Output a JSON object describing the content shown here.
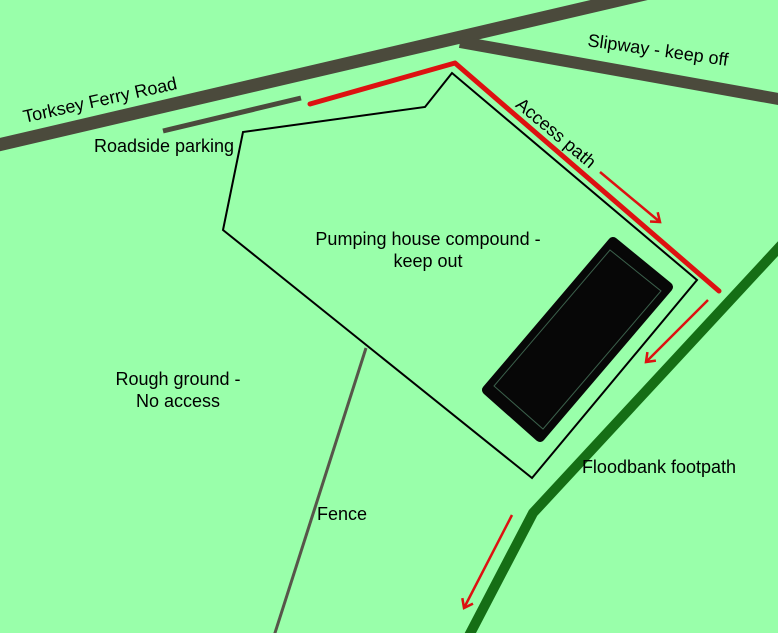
{
  "map": {
    "colors": {
      "background": "#99ffaa",
      "road": "#4b4a3c",
      "boundary": "#000000",
      "fence": "#57564a",
      "access_path": "#dd1111",
      "floodbank": "#156e15",
      "building": "#070707",
      "building_outline": "#4e7f63",
      "label_text": "#000000"
    },
    "labels": {
      "torksey_ferry_road": "Torksey Ferry Road",
      "slipway": "Slipway - keep off",
      "roadside_parking": "Roadside parking",
      "access_path": "Access path",
      "compound_line1": "Pumping house compound -",
      "compound_line2": "keep out",
      "rough_ground_line1": "Rough ground -",
      "rough_ground_line2": "No access",
      "fence": "Fence",
      "floodbank_footpath": "Floodbank footpath"
    }
  }
}
